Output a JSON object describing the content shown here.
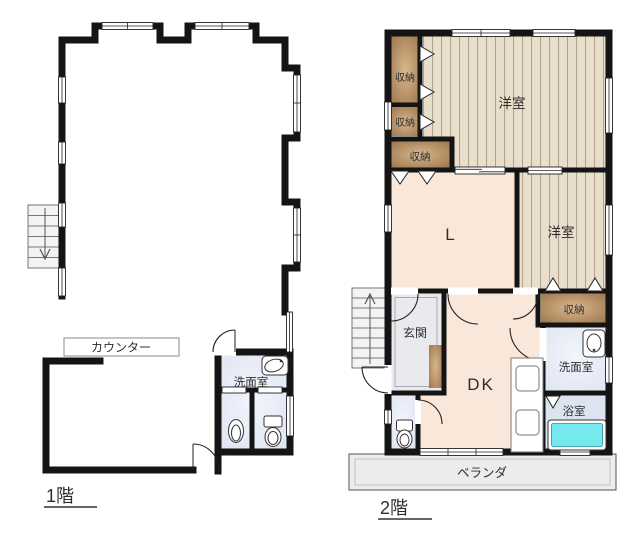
{
  "floor1": {
    "label": "1階",
    "counter_label": "カウンター",
    "washroom_label": "洗面室"
  },
  "floor2": {
    "label": "2階",
    "storage_label_1": "収納",
    "storage_label_2": "収納",
    "storage_label_3": "収納",
    "storage_label_4": "収納",
    "western_room_label_1": "洋室",
    "western_room_label_2": "洋室",
    "living_label": "L",
    "entrance_label": "玄関",
    "dk_label": "DK",
    "washroom_label": "洗面室",
    "bath_label": "浴室",
    "veranda_label": "ベランダ"
  },
  "colors": {
    "wall": "#141414",
    "wood_floor": "#e9ddcb",
    "wood_stripe": "#b2a189",
    "storage_dark": "#9a7248",
    "storage_light": "#d8b78e",
    "living_floor": "#f9e7da",
    "wet_floor": "#dde3f1",
    "bath_floor": "#dce4ef",
    "entrance_floor": "#eaeaee",
    "veranda_floor": "#ececec",
    "bathtub": "#74e9ef"
  }
}
